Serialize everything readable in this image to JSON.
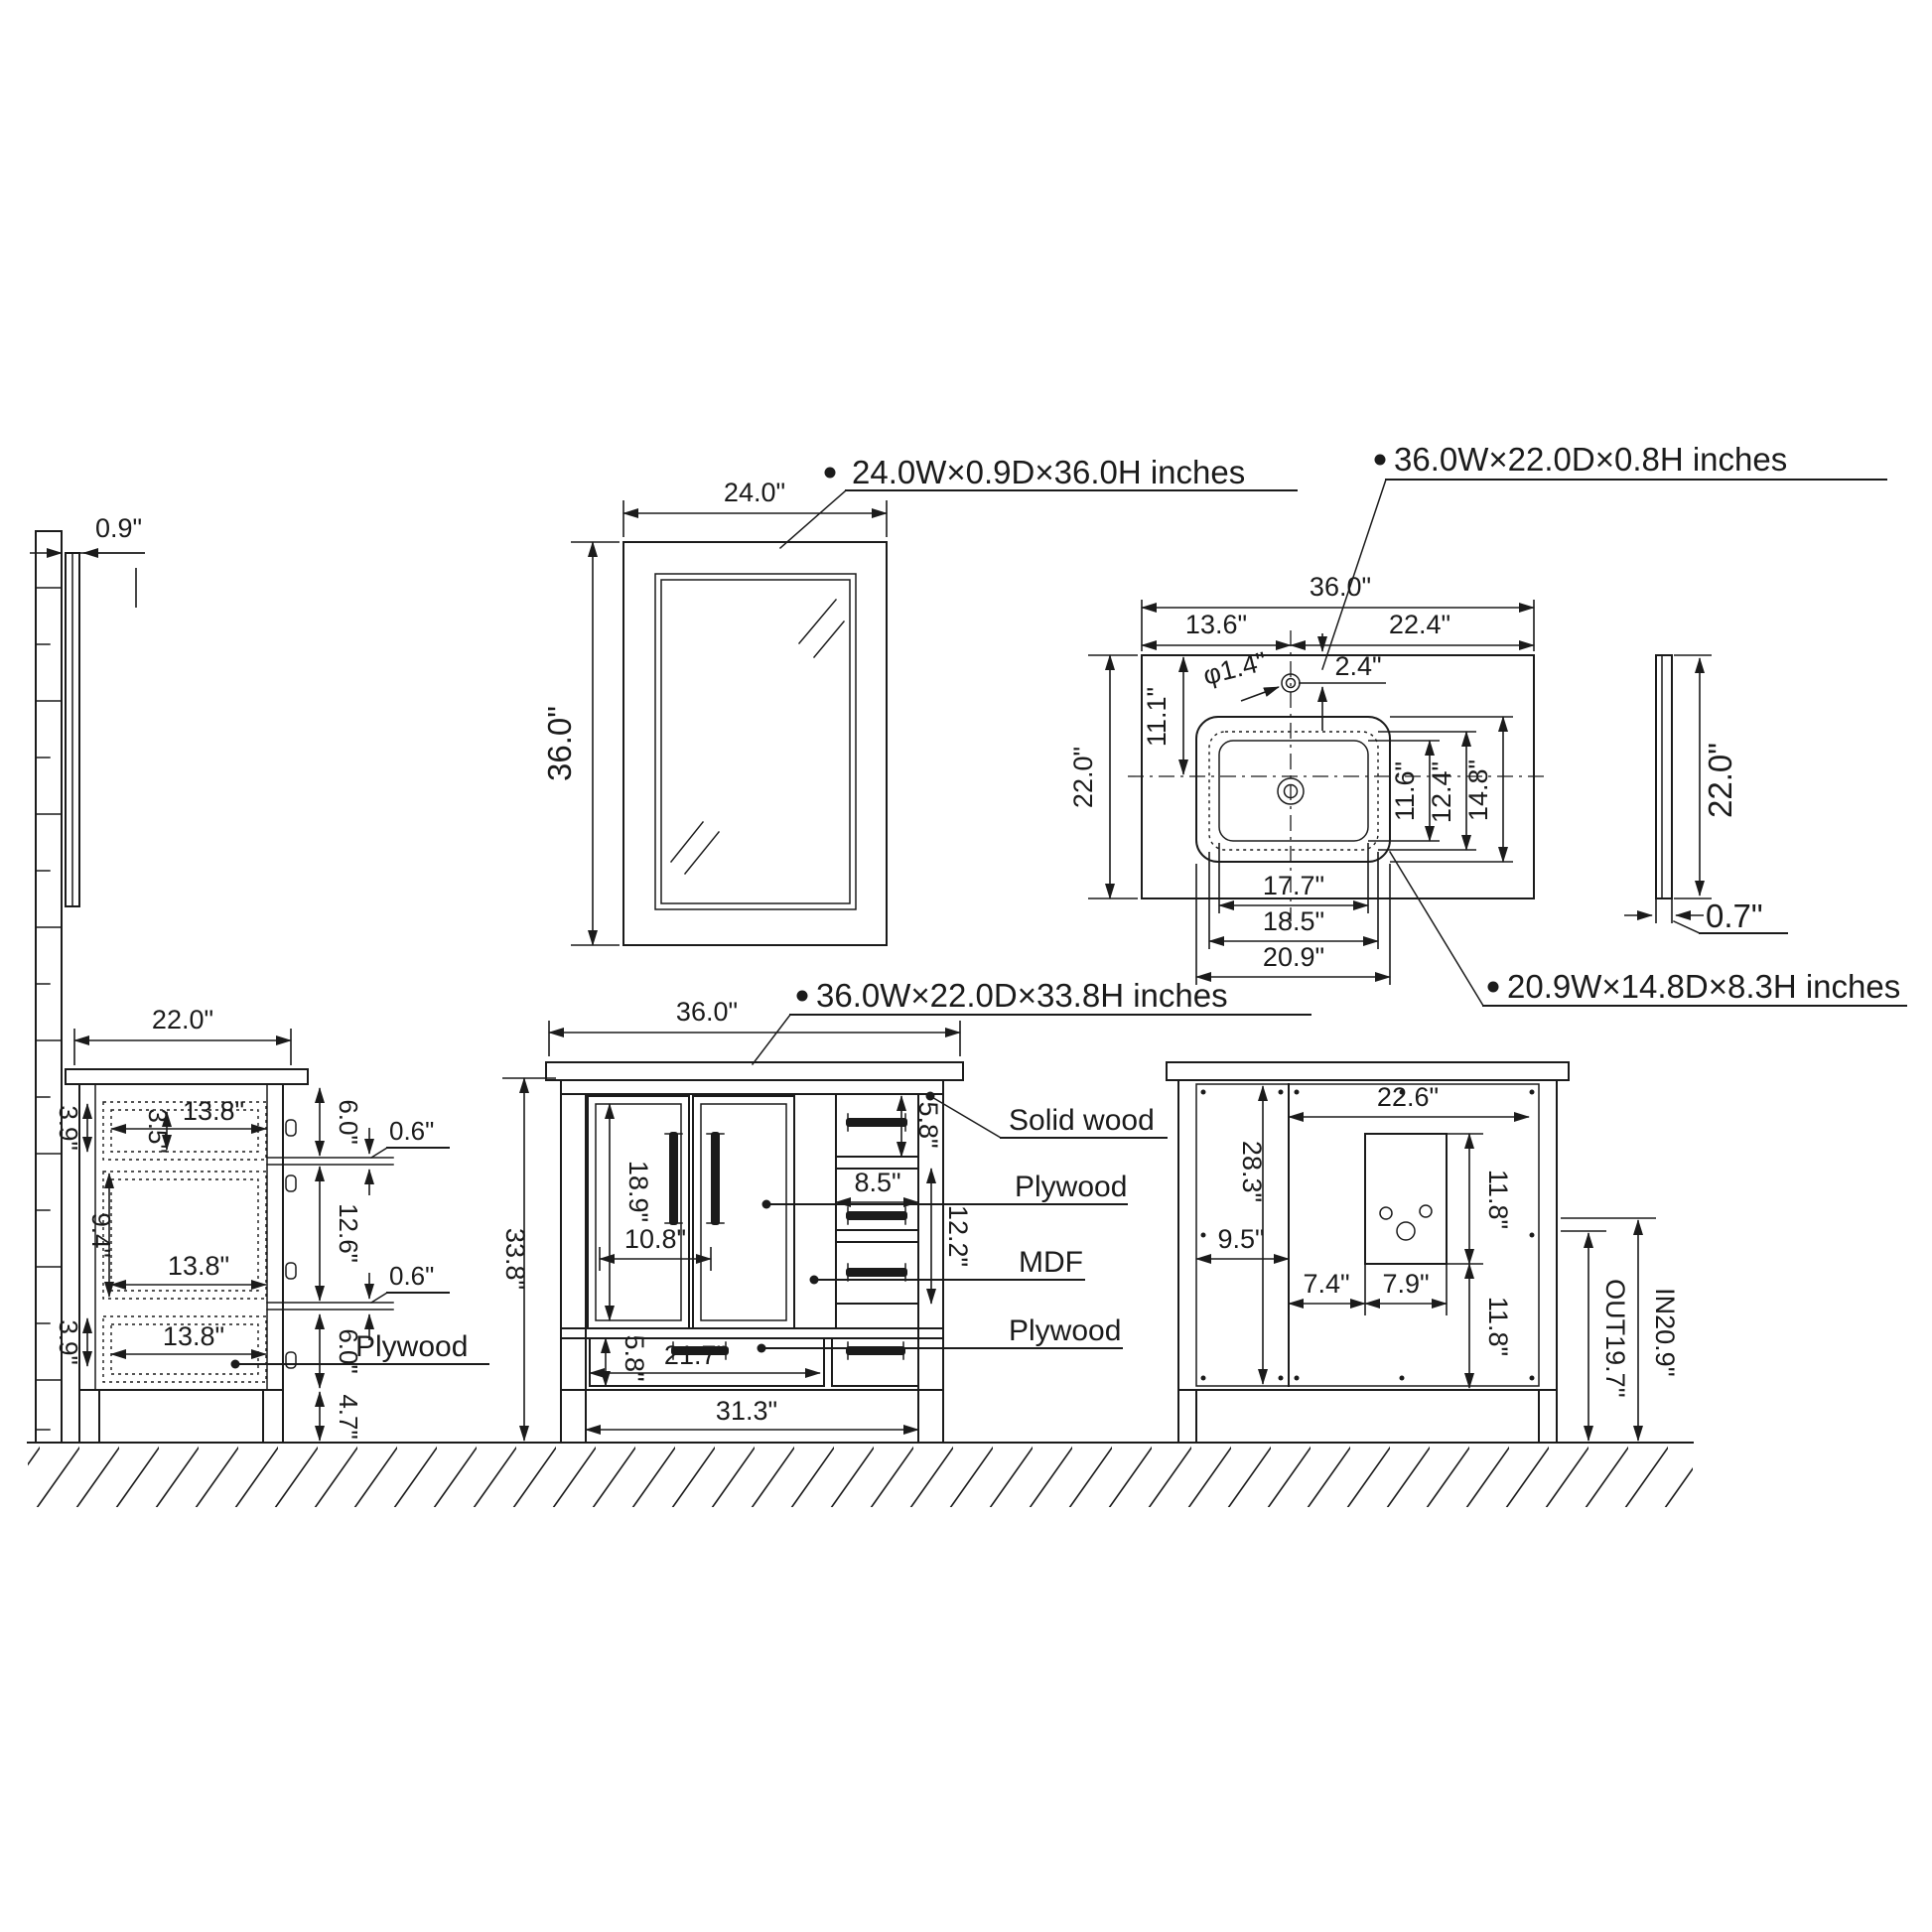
{
  "drawing": {
    "style": {
      "line_color": "#1b1b1b",
      "background": "#ffffff"
    },
    "callouts": {
      "mirror": "24.0W×0.9D×36.0H inches",
      "countertop": "36.0W×22.0D×0.8H inches",
      "sink": "20.9W×14.8D×8.3H inches",
      "vanity": "36.0W×22.0D×33.8H inches"
    },
    "mirror_side": {
      "thickness": "0.9\""
    },
    "mirror_front": {
      "width": "24.0\"",
      "height": "36.0\""
    },
    "countertop_top": {
      "width": "36.0\"",
      "left_split": "13.6\"",
      "right_split": "22.4\"",
      "hole_dia": "φ1.4\"",
      "hole_offset": "2.4\"",
      "front_depth": "11.1\"",
      "depth": "22.0\"",
      "bowl_d1": "11.6\"",
      "bowl_d2": "12.4\"",
      "bowl_d3": "14.8\"",
      "bowl_w1": "17.7\"",
      "bowl_w2": "18.5\"",
      "bowl_w3": "20.9\""
    },
    "countertop_side": {
      "depth": "22.0\"",
      "thickness": "0.7\""
    },
    "cabinet_side": {
      "depth": "22.0\"",
      "d1_front": "3.9\"",
      "d1_box": "3.5\"",
      "d1_width": "13.8\"",
      "top_gap": "6.0\"",
      "rail1": "0.6\"",
      "d2_front": "9.4\"",
      "mid_gap": "12.6\"",
      "d2_width": "13.8\"",
      "d3_front": "3.9\"",
      "d3_width": "13.8\"",
      "bottom_gap": "6.0\"",
      "rail2": "0.6\"",
      "leg": "4.7\"",
      "material": "Plywood"
    },
    "cabinet_front": {
      "width": "36.0\"",
      "height": "33.8\"",
      "door_height": "18.9\"",
      "door_width": "10.8\"",
      "top_drawer": "5.8\"",
      "drawer_width": "8.5\"",
      "drawer_stack": "12.2\"",
      "bottom_drawer": "5.8\"",
      "bottom_width": "21.7\"",
      "base_width": "31.3\"",
      "mat_solid": "Solid wood",
      "mat_ply1": "Plywood",
      "mat_mdf": "MDF",
      "mat_ply2": "Plywood"
    },
    "cabinet_back": {
      "width": "22.6\"",
      "height": "28.3\"",
      "side": "9.5\"",
      "cut_top": "11.8\"",
      "cut_left": "7.4\"",
      "cut_width": "7.9\"",
      "cut_bottom": "11.8\"",
      "out_height": "OUT19.7''",
      "in_height": "IN20.9''"
    }
  }
}
